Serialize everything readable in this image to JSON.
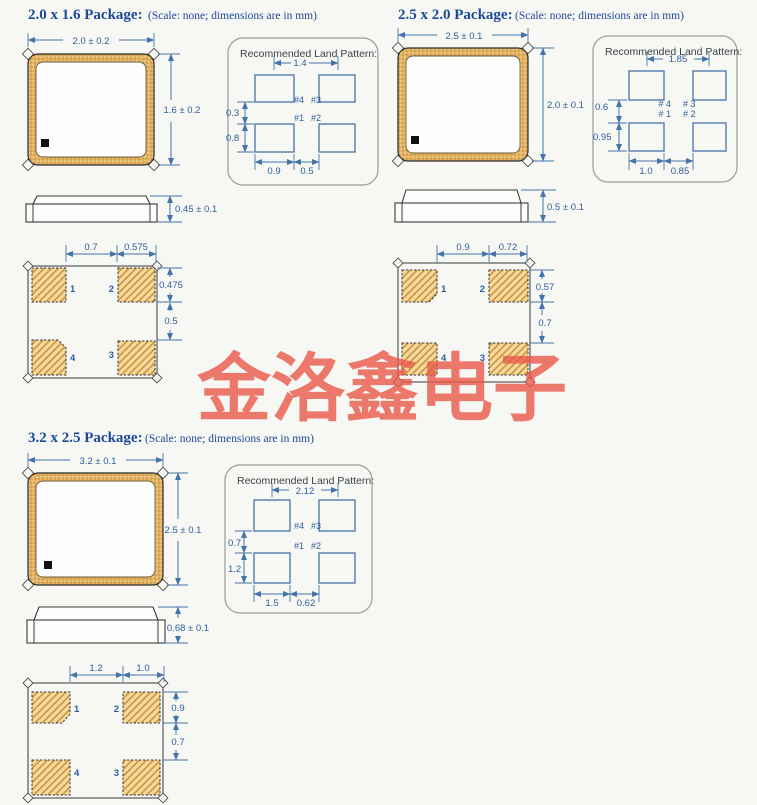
{
  "watermark": {
    "text": "金洛鑫电子"
  },
  "colors": {
    "title_blue": "#1b4a9a",
    "dimension_blue": "#2d5d9f",
    "pad_tan": "#e2b262",
    "watermark_red": "#e95849",
    "background": "#f7f7f4"
  },
  "sections": [
    {
      "title": "2.0 x 1.6 Package:",
      "note": "(Scale: none; dimensions are in mm)",
      "top_view": {
        "width": "2.0 ± 0.2",
        "height": "1.6 ± 0.2"
      },
      "side_view": {
        "thickness": "0.45 ± 0.1"
      },
      "bottom_view": {
        "dim_span_left": "0.7",
        "dim_span_right": "0.575",
        "dim_pad_height": "0.475",
        "dim_row_gap": "0.5",
        "pad_1": "1",
        "pad_2": "2",
        "pad_3": "3",
        "pad_4": "4"
      },
      "land": {
        "title": "Recommended Land Pattern:",
        "dim_pitch": "1.4",
        "dim_row_gap": "0.3",
        "dim_pad_height": "0.8",
        "dim_pad_width": "0.9",
        "dim_col_gap": "0.5",
        "label_p4": "#4",
        "label_p3": "#3",
        "label_p1": "#1",
        "label_p2": "#2"
      }
    },
    {
      "title": "2.5 x 2.0 Package:",
      "note": "(Scale: none; dimensions are in mm)",
      "top_view": {
        "width": "2.5 ± 0.1",
        "height": "2.0 ± 0.1"
      },
      "side_view": {
        "thickness": "0.5 ± 0.1"
      },
      "bottom_view": {
        "dim_span_left": "0.9",
        "dim_span_right": "0.72",
        "dim_pad_height": "0.57",
        "dim_row_gap": "0.7",
        "pad_1": "1",
        "pad_2": "2",
        "pad_3": "3",
        "pad_4": "4"
      },
      "land": {
        "title": "Recommended Land Pattern:",
        "dim_pitch": "1.85",
        "dim_row_gap": "0.6",
        "dim_pad_height": "0.95",
        "dim_pad_width": "1.0",
        "dim_col_gap": "0.85",
        "label_p4": "# 4",
        "label_p3": "# 3",
        "label_p1": "# 1",
        "label_p2": "# 2"
      }
    },
    {
      "title": "3.2 x 2.5 Package:",
      "note": "(Scale: none; dimensions are in mm)",
      "top_view": {
        "width": "3.2 ± 0.1",
        "height": "2.5 ± 0.1"
      },
      "side_view": {
        "thickness": "0.68 ± 0.1"
      },
      "bottom_view": {
        "dim_span_left": "1.2",
        "dim_span_right": "1.0",
        "dim_pad_height": "0.9",
        "dim_row_gap": "0.7",
        "pad_1": "1",
        "pad_2": "2",
        "pad_3": "3",
        "pad_4": "4"
      },
      "land": {
        "title": "Recommended Land Pattern:",
        "dim_pitch": "2.12",
        "dim_row_gap": "0.7",
        "dim_pad_height": "1.2",
        "dim_pad_width": "1.5",
        "dim_col_gap": "0.62",
        "label_p4": "#4",
        "label_p3": "#3",
        "label_p1": "#1",
        "label_p2": "#2"
      }
    }
  ]
}
